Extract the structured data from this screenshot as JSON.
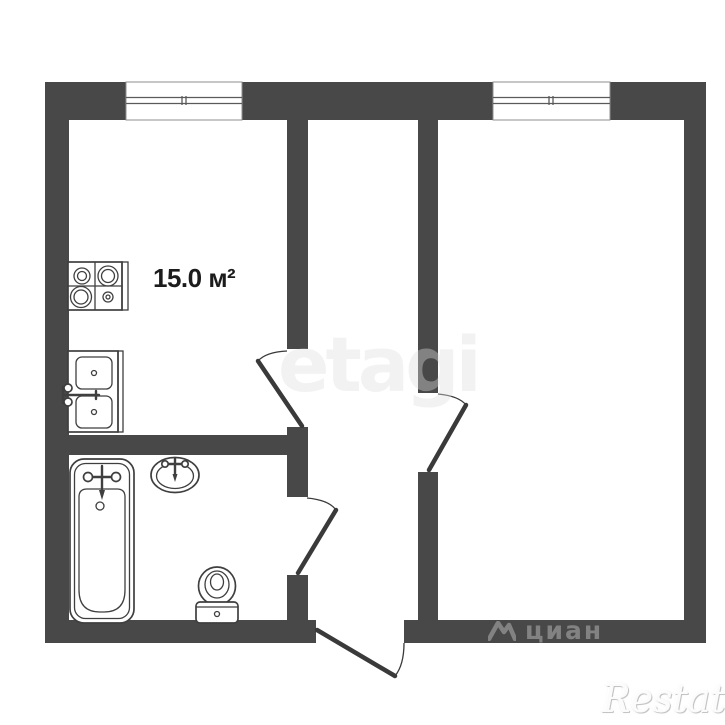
{
  "meta": {
    "type": "apartment-floor-plan"
  },
  "colors": {
    "wall": "#484848",
    "line": "#3f3f3f",
    "bg": "#ffffff",
    "label": "#1c1c1c"
  },
  "rooms": {
    "kitchen": {
      "area_label": "15.0 м²"
    }
  },
  "watermarks": {
    "etagi": "etagi",
    "cian": "циан",
    "restate": "Restate"
  }
}
